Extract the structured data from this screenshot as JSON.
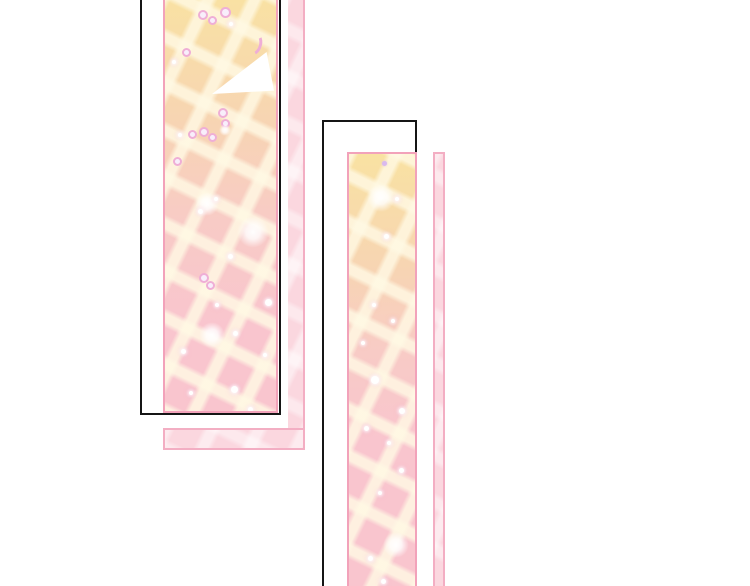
{
  "page": {
    "background_color": "#ffffff",
    "text_content": "",
    "panel_count": 2
  },
  "colors": {
    "page_bg": "#ffffff",
    "ink": "#151515",
    "panel_border": "#f2a2ba",
    "shadow_border": "#f3aec3",
    "shadow_fill": "#fbd7df",
    "tile_yellow": "#f9e2a2",
    "tile_peach": "#f7d5b2",
    "tile_pink_light": "#f8cbc6",
    "tile_pink": "#f9c5ce",
    "grout": "rgba(255,249,228,0.82)",
    "sparkle_pink": "#efaed6",
    "shine_white": "#ffffff"
  },
  "panels": [
    {
      "id": "panel-a",
      "position": "left",
      "cropped_edges": "top",
      "fill": "tile-gradient-yellow-to-pink",
      "decor": [
        "shine-triangle",
        "crescent-sparkle",
        "donut-sparkles",
        "glow-sparkles"
      ]
    },
    {
      "id": "panel-b",
      "position": "right",
      "cropped_edges": "bottom",
      "fill": "tile-gradient-yellow-to-pink",
      "decor": [
        "glow-sparkles",
        "dot-sparkles"
      ]
    }
  ]
}
